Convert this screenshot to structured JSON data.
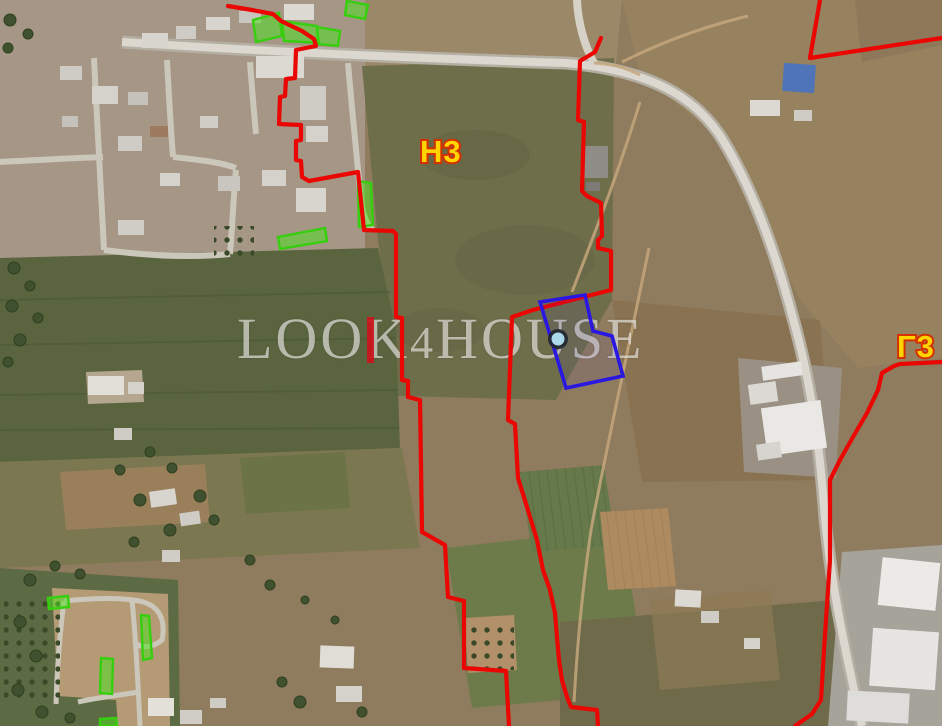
{
  "map_overlay": {
    "watermark": {
      "full_text": "LOOK4HOUSE",
      "segment_pre": "LOO",
      "segment_k": "K",
      "segment_four": "4",
      "segment_post": "HOUSE"
    },
    "zone_labels": [
      {
        "text": "H3",
        "x": "420",
        "y": "162"
      },
      {
        "text": "Γ3",
        "x": "897",
        "y": "357"
      }
    ],
    "colors": {
      "zone_boundary_red": "#ea0603",
      "parcel_outline_blue": "#2a17e0",
      "green_area_fill": "#4ae21e",
      "green_area_stroke": "#35cf0e",
      "zone_label_fill": "#ffd400",
      "zone_label_outline": "#d43000",
      "watermark_text": "rgba(250,250,246,0.60)",
      "watermark_k_stem_red": "#cd121c",
      "marker_center": "#aad7ea",
      "marker_ring": "#20262e"
    }
  }
}
